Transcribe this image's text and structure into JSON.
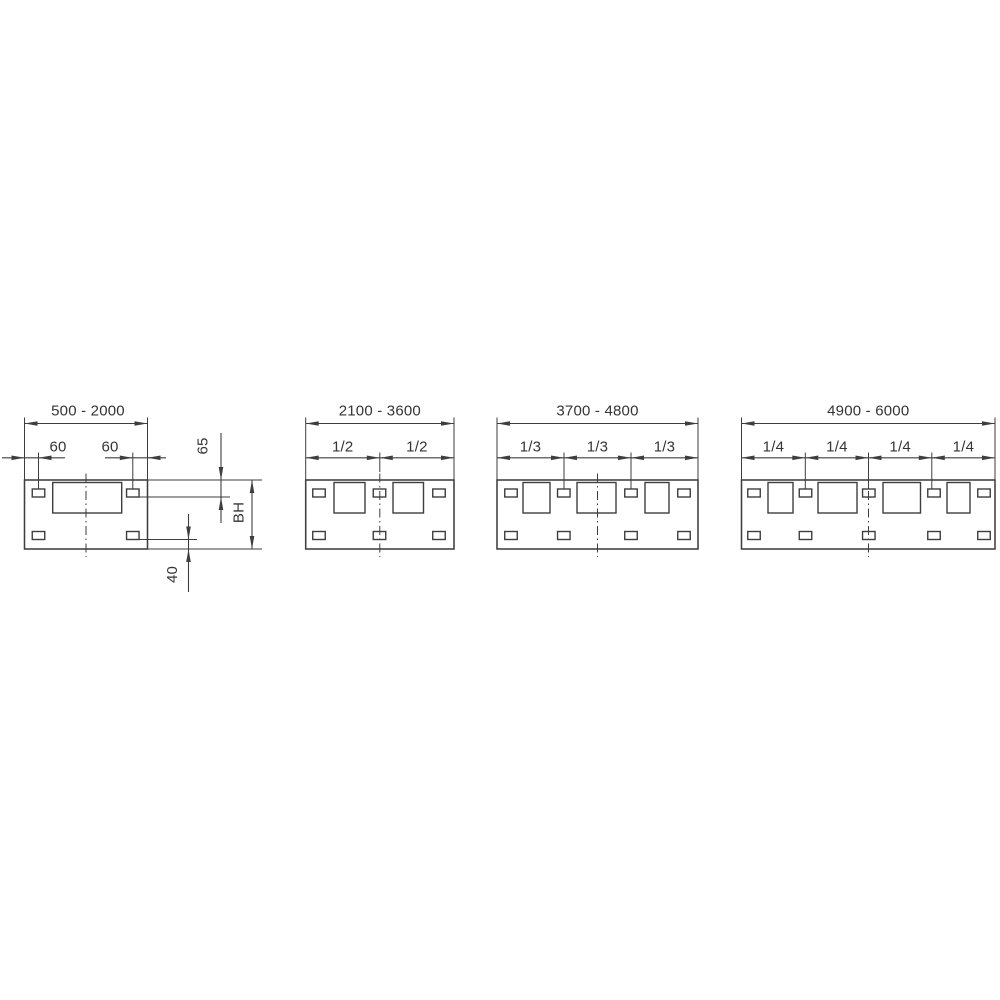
{
  "page": {
    "background": "#ffffff"
  },
  "drawing": {
    "type": "technical-dimension-drawing",
    "description_labels": {
      "view1_width_range": "500 - 2000",
      "view2_width_range": "2100 - 3600",
      "view3_width_range": "3700 - 4800",
      "view4_width_range": "4900 - 6000",
      "edge_offsets": [
        "60",
        "60"
      ],
      "vertical_dims": [
        "65",
        "BH",
        "40"
      ],
      "divisions_view2": [
        "1/2",
        "1/2"
      ],
      "divisions_view3": [
        "1/3",
        "1/3",
        "1/3"
      ],
      "divisions_view4": [
        "1/4",
        "1/4",
        "1/4",
        "1/4"
      ]
    },
    "line_color": "#3e3e3e",
    "text_color": "#343434",
    "font_size_px": 15,
    "layout": {
      "panel_top": 480,
      "panel_h": 69,
      "win_top": 482.5,
      "win_h": 30.5,
      "slot_top_y": 489,
      "slot_bot_y": 531.5,
      "slot_w": 12.5,
      "slot_h": 8,
      "main_dim_y": 423.5,
      "main_ext_top": 417.5,
      "main_text_y": 415.5,
      "sec_dim_y": 457.8,
      "sec_ext_top": 452.5,
      "sec_text_y": 451.5,
      "center_top": 473.5,
      "center_bot": 557,
      "arrow_len": 13,
      "arrow_hw": 2.3
    },
    "views": [
      {
        "name": "view-1",
        "width_range_label": "500 - 2000",
        "label_x": 88,
        "x": 24.5,
        "w": 123,
        "center_x": 86,
        "windows": [
          [
            52.7,
            69
          ]
        ],
        "slot_centers": [
          38.5,
          132.8
        ],
        "division_labels": [],
        "boundaries": [],
        "boundary_ext_bottom": 489,
        "edge_dims": [
          {
            "label": "60",
            "span": [
              24.5,
              38.5
            ],
            "line": [
              2,
              65
            ],
            "text_x": 58
          },
          {
            "label": "60",
            "span": [
              132.8,
              147.5
            ],
            "line": [
              105,
              166
            ],
            "text_x": 110
          }
        ],
        "side_refs": [
          {
            "y": 480,
            "x1": 147.5,
            "x2": 262
          },
          {
            "y": 497,
            "x1": 139,
            "x2": 230
          },
          {
            "y": 539.5,
            "x1": 139,
            "x2": 197
          },
          {
            "y": 549,
            "x1": 147.5,
            "x2": 262
          }
        ],
        "vertical_dims": [
          {
            "label": "65",
            "x": 221,
            "line": [
              433,
              523
            ],
            "arrows": [
              {
                "tip": 480,
                "dir": "down"
              },
              {
                "tip": 497,
                "dir": "up"
              }
            ],
            "text": [
              207.5,
              446
            ]
          },
          {
            "label": "BH",
            "x": 252,
            "line": [
              480,
              549
            ],
            "arrows": [
              {
                "tip": 480,
                "dir": "up"
              },
              {
                "tip": 549,
                "dir": "down"
              }
            ],
            "text": [
              243.5,
              512.5
            ]
          },
          {
            "label": "40",
            "x": 188.5,
            "line": [
              514,
              592
            ],
            "arrows": [
              {
                "tip": 539.5,
                "dir": "down"
              },
              {
                "tip": 549,
                "dir": "up"
              }
            ],
            "text": [
              177,
              574.5
            ]
          }
        ]
      },
      {
        "name": "view-2",
        "width_range_label": "2100 - 3600",
        "x": 305.7,
        "w": 148.3,
        "center_x": 379.8,
        "windows": [
          [
            334,
            31
          ],
          [
            393,
            30.5
          ]
        ],
        "slot_centers": [
          319,
          379.5,
          439
        ],
        "division_labels": [
          "1/2",
          "1/2"
        ],
        "boundaries": [
          379.8
        ],
        "boundary_ext_bottom": 472,
        "edge_dims": [],
        "side_refs": [],
        "vertical_dims": []
      },
      {
        "name": "view-3",
        "width_range_label": "3700 - 4800",
        "x": 497,
        "w": 201,
        "center_x": 597.5,
        "windows": [
          [
            523,
            27
          ],
          [
            577,
            39
          ],
          [
            645,
            24
          ]
        ],
        "slot_centers": [
          511,
          563.8,
          631,
          684
        ],
        "division_labels": [
          "1/3",
          "1/3",
          "1/3"
        ],
        "boundaries": [
          564,
          631
        ],
        "boundary_ext_bottom": 489,
        "edge_dims": [],
        "side_refs": [],
        "vertical_dims": []
      },
      {
        "name": "view-4",
        "width_range_label": "4900 - 6000",
        "x": 741.5,
        "w": 253.5,
        "center_x": 868.5,
        "windows": [
          [
            768,
            25
          ],
          [
            818,
            39
          ],
          [
            883,
            37.5
          ],
          [
            947,
            23
          ]
        ],
        "slot_centers": [
          754,
          805.5,
          868.8,
          934,
          984
        ],
        "division_labels": [
          "1/4",
          "1/4",
          "1/4",
          "1/4"
        ],
        "boundaries": [
          805.3,
          868.5,
          931.8
        ],
        "boundary_ext_bottom": 489,
        "edge_dims": [],
        "side_refs": [],
        "vertical_dims": []
      }
    ]
  }
}
